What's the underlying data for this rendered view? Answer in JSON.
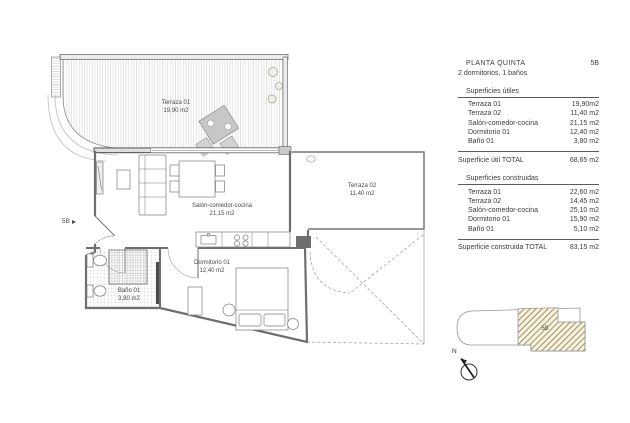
{
  "plan": {
    "entry": {
      "label": "5B"
    },
    "labels": {
      "terraza01": {
        "name": "Terraza 01",
        "area": "19,90 m2"
      },
      "terraza02": {
        "name": "Terraza 02",
        "area": "11,40 m2"
      },
      "salon": {
        "name": "Salón-comedor-cocina",
        "area": "21,15 m2"
      },
      "dormitorio": {
        "name": "Dormitorio 01",
        "area": "12,40 m2"
      },
      "bano": {
        "name": "Baño 01",
        "area": "3,80 m2"
      }
    },
    "compass": {
      "label": "N"
    },
    "keyplan": {
      "unit_label": "5B",
      "hatch_color": "#a3905a"
    }
  },
  "panel": {
    "title": "PLANTA QUINTA",
    "unit": "5B",
    "subtitle": "2 dormitorios, 1 baños",
    "useful": {
      "heading": "Superficies útiles",
      "rows": [
        {
          "label": "Terraza 01",
          "value": "19,90m2"
        },
        {
          "label": "Terraza 02",
          "value": "11,40 m2"
        },
        {
          "label": "Salón-comedor-cocina",
          "value": "21,15 m2"
        },
        {
          "label": "Dormitorio 01",
          "value": "12,40 m2"
        },
        {
          "label": "Baño 01",
          "value": "3,80 m2"
        }
      ],
      "total_label": "Superficie útil TOTAL",
      "total_value": "68,65 m2"
    },
    "built": {
      "heading": "Superficies  construidas",
      "rows": [
        {
          "label": "Terraza 01",
          "value": "22,60 m2"
        },
        {
          "label": "Terraza 02",
          "value": "14,45 m2"
        },
        {
          "label": "Salón-comedor-cocina",
          "value": "25,10 m2"
        },
        {
          "label": "Dormitorio 01",
          "value": "15,90 m2"
        },
        {
          "label": "Baño 01",
          "value": "5,10 m2"
        }
      ],
      "total_label": "Superficie construida TOTAL",
      "total_value": "83,15 m2"
    }
  }
}
